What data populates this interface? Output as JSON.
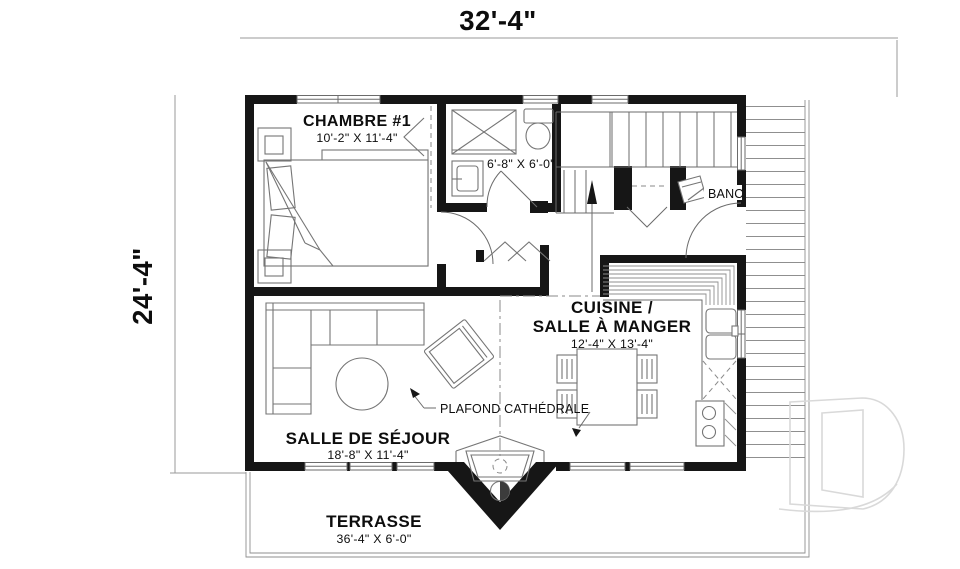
{
  "plan": {
    "overall_width": "32'-4\"",
    "overall_height": "24'-4\"",
    "rooms": {
      "chambre": {
        "name": "CHAMBRE #1",
        "size": "10'-2\" X 11'-4\""
      },
      "salle_de_bain": {
        "size": "6'-8\" X 6'-0\""
      },
      "cuisine": {
        "name_line1": "CUISINE /",
        "name_line2": "SALLE À MANGER",
        "size": "12'-4\" X 13'-4\""
      },
      "sejour": {
        "name": "SALLE DE SÉJOUR",
        "size": "18'-8\" X 11'-4\""
      },
      "terrasse": {
        "name": "TERRASSE",
        "size": "36'-4\" X 6'-0\""
      }
    },
    "annotations": {
      "banc": "BANC",
      "plafond": "PLAFOND CATHÉDRALE"
    },
    "colors": {
      "wall": "#161616",
      "thin_line": "#6b6b6b",
      "furniture_line": "#757575",
      "dimension_text": "#0d0d0d",
      "watermark": "#d9d9d9",
      "background": "#ffffff"
    }
  }
}
